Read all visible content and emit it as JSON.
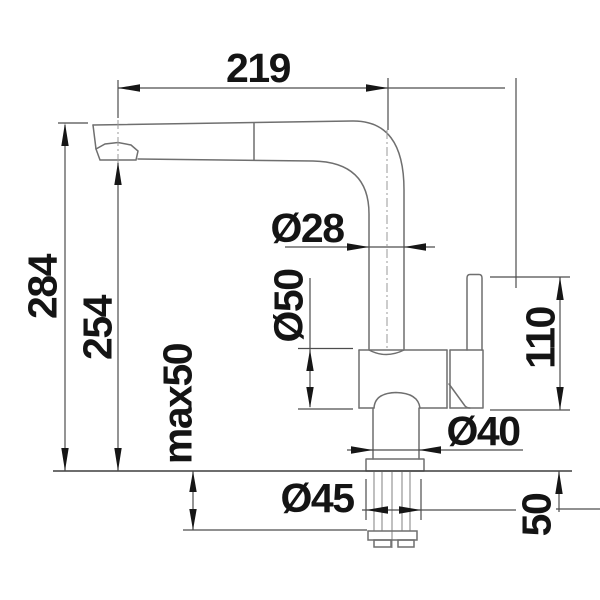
{
  "drawing": {
    "dimensions": {
      "reach": "219",
      "overall_height": "284",
      "spout_height": "254",
      "max_mounting_thickness": "max50",
      "pipe_diameter": "Ø28",
      "body_diameter": "Ø50",
      "handle_clearance": "110",
      "neck_diameter": "Ø40",
      "base_diameter": "Ø45",
      "shank_length": "50"
    },
    "colors": {
      "background": "#ffffff",
      "geometry_line": "#6f6f6f",
      "dimension_line": "#4d4d4d",
      "text": "#141414"
    }
  }
}
